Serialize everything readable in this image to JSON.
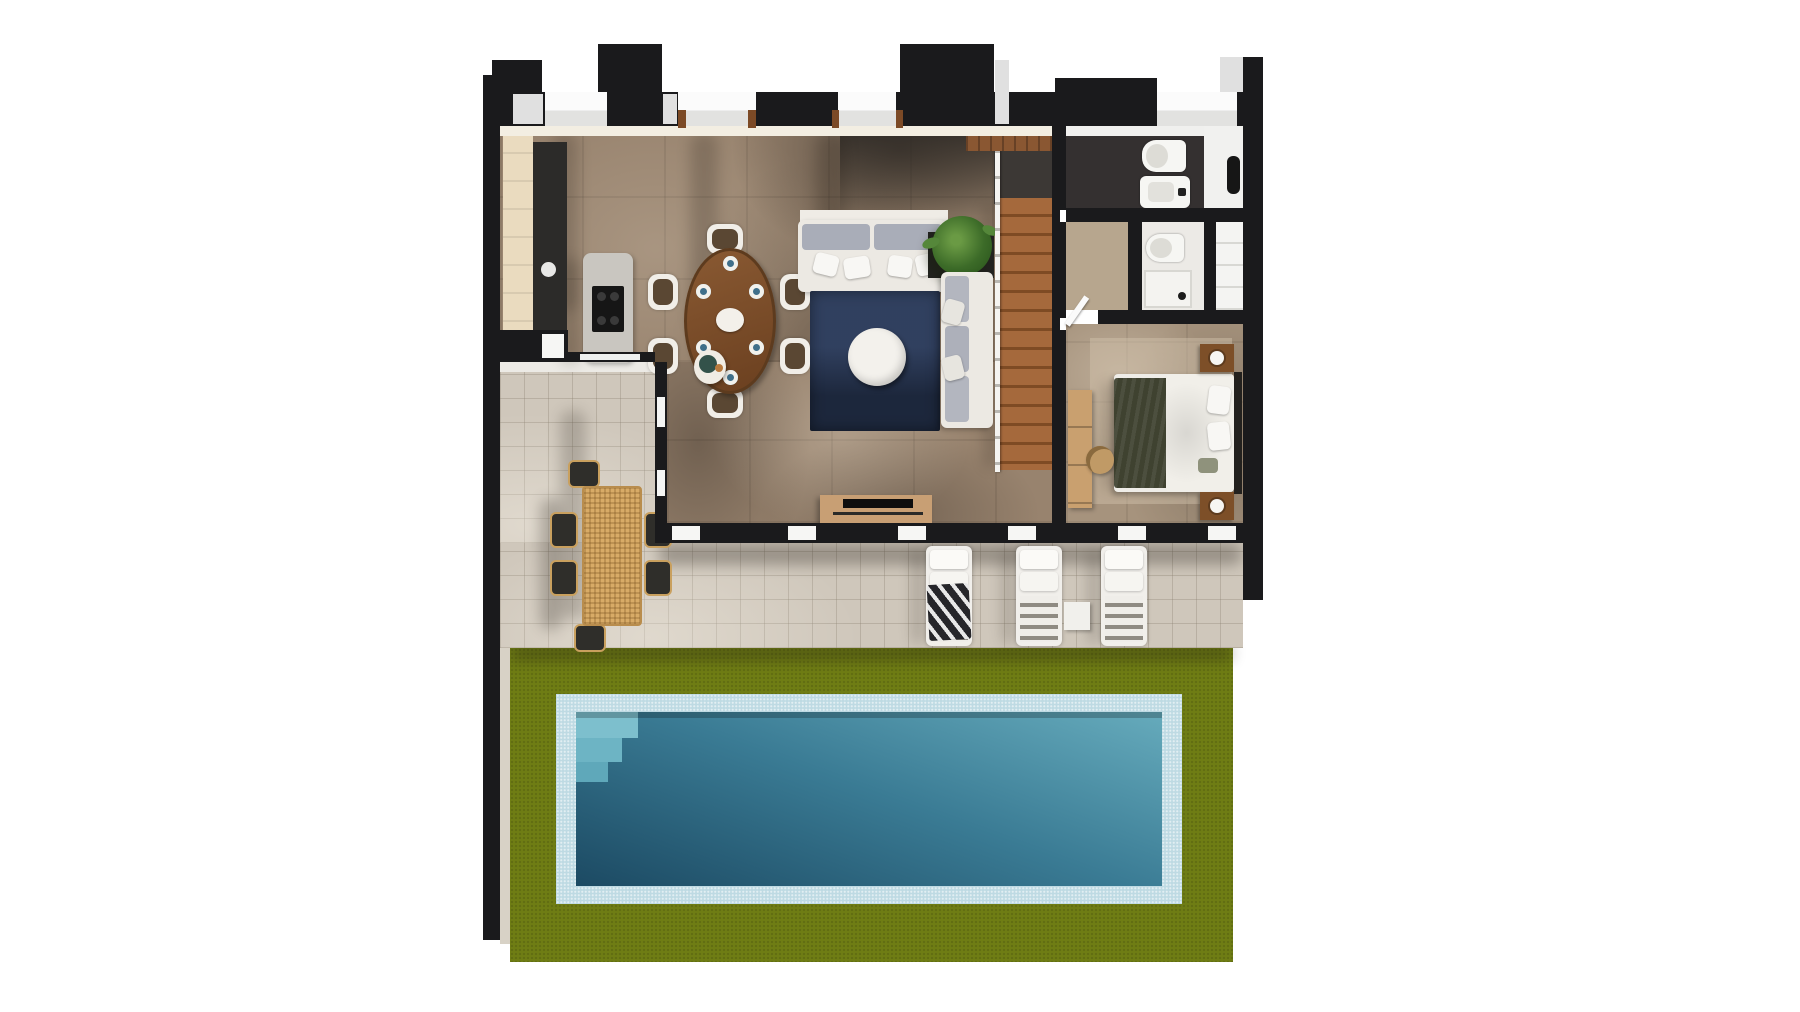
{
  "scene": {
    "type": "3d-floor-plan-render",
    "view": "top-down axonometric",
    "description": "Ground floor of a modern villa with open-plan kitchen, dining and living area, entry hall, two bathrooms, bedroom, wooden staircase, covered terrace with sun loungers, lawn and rectangular swimming pool",
    "background": "#ffffff"
  },
  "palette": {
    "wall": "#1a1a1c",
    "wall_face_light": "#e0e0e0",
    "interior_wall_cream": "#eadbbf",
    "floor_living": "#98836e",
    "floor_entry_dark": "#3c3835",
    "floor_bedroom": "#a6937d",
    "floor_bathroom_dark": "#343030",
    "terrace_tile": "#cfc7bb",
    "lawn": "#6f7d14",
    "pool_rim": "#bedae3",
    "pool_water_deep": "#1c4a63",
    "pool_water_light": "#66abbc",
    "stairs_wood": "#9c5f33",
    "rug_navy": "#263450",
    "sofa_white": "#ece9e3",
    "cushion_gray": "#a9adb8",
    "dining_table_wood": "#7a4f2e",
    "rattan": "#d8ab67",
    "tv_console_tan": "#c89f74",
    "bed_blanket_olive": "#3f4230",
    "nightstand_wood": "#7d4f28",
    "plant_green": "#4e7d35",
    "kitchen_counter_dark": "#2c2b29",
    "island_gray": "#c9c6c0"
  },
  "rooms": {
    "kitchen": {
      "label": "Kitchen"
    },
    "dining": {
      "label": "Dining area"
    },
    "living": {
      "label": "Living room"
    },
    "entry": {
      "label": "Entrance hall"
    },
    "stairs": {
      "label": "Staircase"
    },
    "bathroom_main": {
      "label": "Bathroom"
    },
    "bathroom_shower": {
      "label": "Shower room"
    },
    "bedroom": {
      "label": "Bedroom"
    },
    "terrace": {
      "label": "Terrace"
    },
    "lawn": {
      "label": "Garden lawn"
    },
    "pool": {
      "label": "Swimming pool"
    }
  },
  "furniture_counts": {
    "dining_chairs": 6,
    "dining_place_settings": 6,
    "sofas": 2,
    "coffee_tables": 1,
    "kitchen_islands": 1,
    "outdoor_dining_chairs": 6,
    "sun_loungers": 3,
    "beds": 1,
    "nightstands": 2,
    "toilets": 2,
    "sinks": 2,
    "showers": 1,
    "plants": 1
  }
}
